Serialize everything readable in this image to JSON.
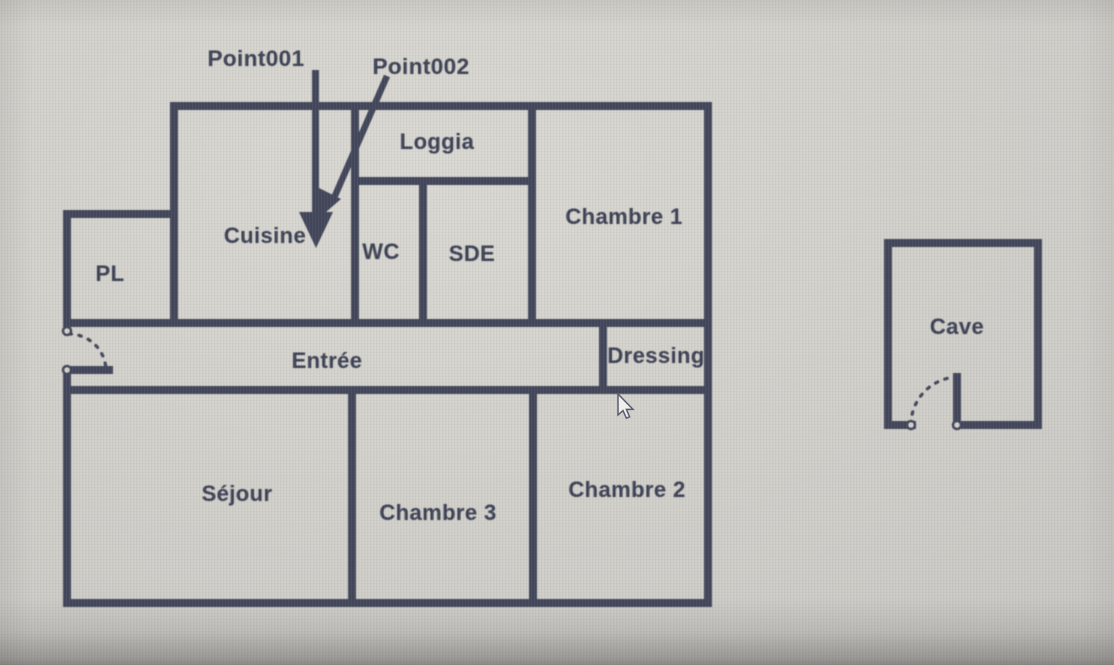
{
  "annotations": {
    "point1": "Point001",
    "point2": "Point002"
  },
  "rooms": {
    "pl": "PL",
    "cuisine": "Cuisine",
    "loggia": "Loggia",
    "wc": "WC",
    "sde": "SDE",
    "chambre1": "Chambre 1",
    "entree": "Entrée",
    "dressing": "Dressing",
    "sejour": "Séjour",
    "chambre3": "Chambre 3",
    "chambre2": "Chambre 2",
    "cave": "Cave"
  },
  "icons": {
    "arrow1": "annotation-arrow-down",
    "arrow2": "annotation-arrow-diagonal",
    "cursor": "mouse-arrow-cursor",
    "door_entrance": "door-swing-arc",
    "door_cave": "door-swing-arc"
  },
  "colors": {
    "wall": "#42465a",
    "label_text": "#3d4255",
    "background": "#d4d2cc",
    "cursor_fill": "#f0efec",
    "cursor_outline": "#5a5d6e"
  }
}
